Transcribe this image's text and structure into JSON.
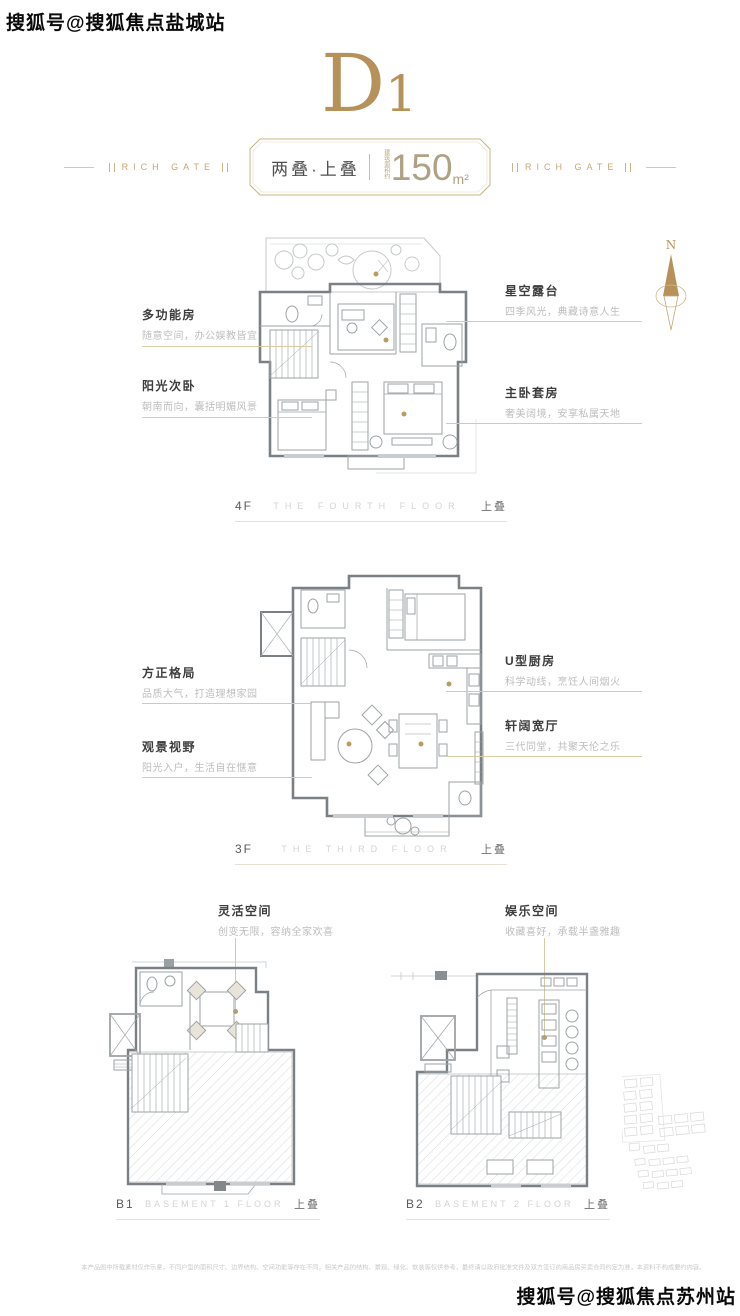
{
  "watermarks": {
    "top": "搜狐号@搜狐焦点盐城站",
    "bottom": "搜狐号@搜狐焦点苏州站"
  },
  "header": {
    "unit_letter": "D",
    "unit_number": "1",
    "brand": "RICH GATE",
    "badge": {
      "type": "两叠·上叠",
      "area_prefix": "建筑面积约",
      "area_value": "150",
      "area_unit": "m²"
    }
  },
  "compass": {
    "north_label": "N"
  },
  "floors": [
    {
      "id": "4F",
      "caption_en": "THE FOURTH FLOOR",
      "stack_label": "上叠",
      "labels_left": [
        {
          "title": "多功能房",
          "desc": "随意空间，办公娱教皆宜"
        },
        {
          "title": "阳光次卧",
          "desc": "朝南而向，囊括明媚风景"
        }
      ],
      "labels_right": [
        {
          "title": "星空露台",
          "desc": "四季风光，典藏诗意人生"
        },
        {
          "title": "主卧套房",
          "desc": "奢美阔境，安享私属天地"
        }
      ]
    },
    {
      "id": "3F",
      "caption_en": "THE THIRD FLOOR",
      "stack_label": "上叠",
      "labels_left": [
        {
          "title": "方正格局",
          "desc": "品质大气，打造理想家园"
        },
        {
          "title": "观景视野",
          "desc": "阳光入户，生活自在惬意"
        }
      ],
      "labels_right": [
        {
          "title": "U型厨房",
          "desc": "科学动线，烹饪人间烟火"
        },
        {
          "title": "轩阔宽厅",
          "desc": "三代同堂，共聚天伦之乐"
        }
      ]
    },
    {
      "id": "B1",
      "caption_en": "BASEMENT 1 FLOOR",
      "stack_label": "上叠",
      "label": {
        "title": "灵活空间",
        "desc": "创变无限，容纳全家欢喜"
      }
    },
    {
      "id": "B2",
      "caption_en": "BASEMENT 2 FLOOR",
      "stack_label": "上叠",
      "label": {
        "title": "娱乐空间",
        "desc": "收藏喜好，承载半盏雅趣"
      }
    }
  ],
  "disclaimer": "本产品图中所载素材仅作示意，不同户型的面积尺寸、边界结构、空间功能等存在不同，相关产品的结构、景观、绿化、软装等仅供参考，最终请以政府批准文件及双方签订的商品房买卖合同约定为准，本资料不构成要约内容。",
  "colors": {
    "accent_gold": "#b6925a",
    "line_gold": "#d9caa4",
    "plan_wall": "#7b8084",
    "plan_line": "#9ea3a6"
  }
}
